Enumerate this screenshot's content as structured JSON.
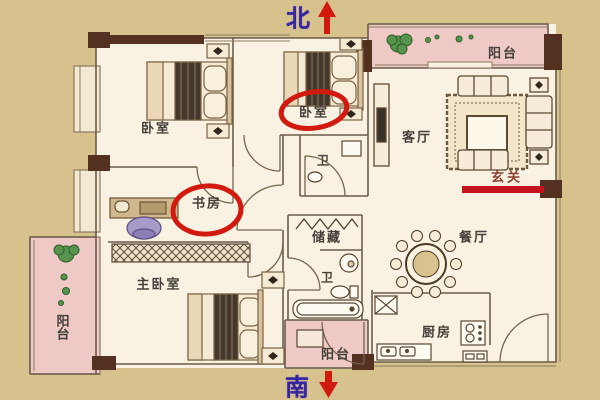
{
  "floor_plan": {
    "compass": {
      "north": "北",
      "south": "南"
    },
    "rooms": {
      "bedroom_top_left": {
        "label": "卧室",
        "circled": false
      },
      "bedroom_top_mid": {
        "label": "卧室",
        "circled": true
      },
      "bathroom_top": {
        "label": "卫",
        "circled": false
      },
      "living_room": {
        "label": "客厅",
        "circled": false
      },
      "balcony_top_right": {
        "label": "阳台",
        "circled": false
      },
      "entry": {
        "label": "玄关",
        "marked_with_red_line": true
      },
      "study": {
        "label": "书房",
        "circled": true
      },
      "master_bedroom": {
        "label": "主卧室",
        "circled": false
      },
      "balcony_left": {
        "label": "阳台",
        "circled": false
      },
      "storage": {
        "label": "储藏",
        "circled": false
      },
      "bathroom_mid": {
        "label": "卫",
        "circled": false
      },
      "dining_room": {
        "label": "餐厅",
        "circled": false
      },
      "kitchen": {
        "label": "厨房",
        "circled": false
      },
      "balcony_bottom": {
        "label": "阳台",
        "circled": false
      }
    },
    "annotations": {
      "highlighted_rooms": [
        "卧室",
        "书房"
      ],
      "entry_marker": "red line under 玄关"
    },
    "colors": {
      "background": "#d7c18d",
      "floor": "#f9f1e1",
      "balcony_pink": "#eec9c6",
      "wall_line": "#6a5c4a",
      "wall_block": "#53301f",
      "highlight_red": "#d2190d",
      "entry_line_red": "#c2131f",
      "compass_text": "#37259e",
      "label_text": "#45403a",
      "plant_green": "#57944d"
    }
  }
}
